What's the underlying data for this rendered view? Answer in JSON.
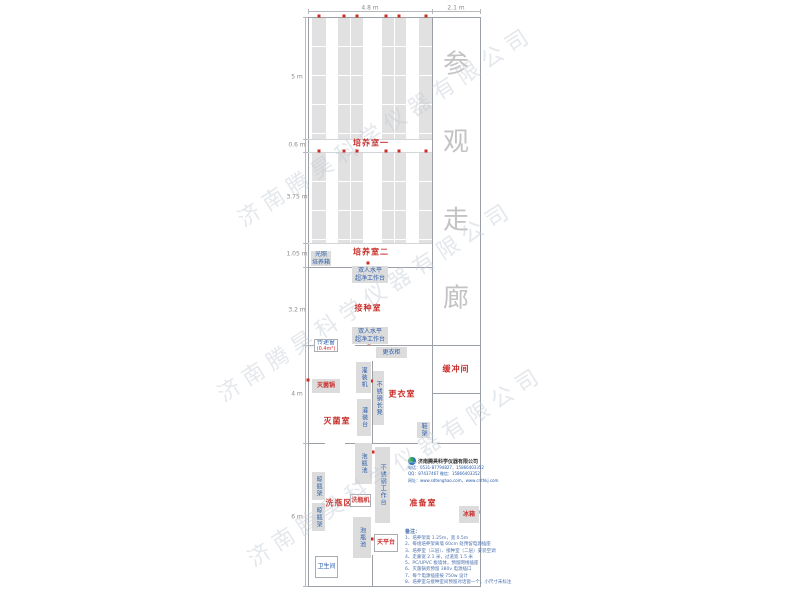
{
  "watermark": {
    "text": "济南腾昊科学仪器有限公司"
  },
  "watermarks": [
    {
      "cx": 385,
      "cy": 125
    },
    {
      "cx": 365,
      "cy": 300
    },
    {
      "cx": 395,
      "cy": 465
    }
  ],
  "corridor": {
    "label": "参观走廊",
    "x": 456,
    "chars": [
      {
        "c": "参",
        "y": 62
      },
      {
        "c": "观",
        "y": 140
      },
      {
        "c": "走",
        "y": 218
      },
      {
        "c": "廊",
        "y": 296
      }
    ]
  },
  "dimensions": {
    "top": {
      "line": {
        "x1": 308,
        "x2": 480,
        "y": 11
      },
      "ticks": [
        308,
        432,
        480
      ],
      "labels": [
        {
          "label": "4.8 m",
          "cx": 370,
          "cy": 8
        },
        {
          "label": "2.1 m",
          "cx": 456,
          "cy": 8
        }
      ]
    },
    "left": {
      "line": {
        "y1": 17,
        "y2": 586,
        "x": 305
      },
      "ticks": [
        17,
        139,
        152,
        243,
        267,
        345,
        443,
        586
      ],
      "labels": [
        {
          "label": "5 m",
          "cy": 77
        },
        {
          "label": "0.6 m",
          "cy": 145
        },
        {
          "label": "3.75 m",
          "cy": 197
        },
        {
          "label": "1.05 m",
          "cy": 254
        },
        {
          "label": "3.2 m",
          "cy": 310
        },
        {
          "label": "4 m",
          "cy": 394
        },
        {
          "label": "6 m",
          "cy": 517
        }
      ]
    }
  },
  "plan": {
    "walls": [
      {
        "x": 308,
        "y": 17,
        "w": 173,
        "h": 1
      },
      {
        "x": 308,
        "y": 586,
        "w": 173,
        "h": 1
      },
      {
        "x": 308,
        "y": 17,
        "w": 1,
        "h": 570
      },
      {
        "x": 480,
        "y": 17,
        "w": 1,
        "h": 570
      },
      {
        "x": 432,
        "y": 17,
        "w": 1,
        "h": 426
      },
      {
        "x": 308,
        "y": 267,
        "w": 125,
        "h": 1
      },
      {
        "x": 308,
        "y": 345,
        "w": 27,
        "h": 1
      },
      {
        "x": 355,
        "y": 345,
        "w": 126,
        "h": 1
      },
      {
        "x": 372,
        "y": 361,
        "w": 1,
        "h": 82
      },
      {
        "x": 432,
        "y": 393,
        "w": 49,
        "h": 1
      },
      {
        "x": 308,
        "y": 443,
        "w": 17,
        "h": 1
      },
      {
        "x": 345,
        "y": 443,
        "w": 73,
        "h": 1
      },
      {
        "x": 437,
        "y": 443,
        "w": 44,
        "h": 1
      },
      {
        "x": 372,
        "y": 555,
        "w": 1,
        "h": 31
      },
      {
        "x": 308,
        "y": 139,
        "w": 124,
        "h": 1,
        "light": true
      },
      {
        "x": 308,
        "y": 152,
        "w": 124,
        "h": 1,
        "light": true
      },
      {
        "x": 308,
        "y": 243,
        "w": 124,
        "h": 1,
        "light": true
      }
    ],
    "rack_sections": [
      {
        "y": 18,
        "h": 121
      },
      {
        "y": 153,
        "h": 90
      }
    ],
    "rack_cols": [
      {
        "x": 312,
        "w": 14
      },
      {
        "x": 338,
        "w": 25,
        "mid": 350
      },
      {
        "x": 382,
        "w": 24,
        "mid": 394
      },
      {
        "x": 419,
        "w": 13
      }
    ],
    "outlet_rows": [
      {
        "y": 16,
        "xs": [
          319,
          344,
          357,
          386,
          399,
          426
        ]
      },
      {
        "y": 151,
        "xs": [
          319,
          344,
          357,
          386,
          399,
          426
        ]
      }
    ],
    "outlets": [
      [
        368,
        263
      ],
      [
        369,
        343
      ],
      [
        372,
        381
      ],
      [
        308,
        380
      ],
      [
        373,
        452
      ],
      [
        369,
        481
      ],
      [
        372,
        539
      ],
      [
        478,
        512
      ]
    ]
  },
  "rooms": [
    {
      "id": "culture-room-1",
      "label": "培养室一",
      "cx": 371,
      "cy": 143
    },
    {
      "id": "culture-room-2",
      "label": "培养室二",
      "cx": 371,
      "cy": 252
    },
    {
      "id": "inoculation-room",
      "label": "接种室",
      "cx": 368,
      "cy": 308
    },
    {
      "id": "sterilization-room",
      "label": "灭菌室",
      "cx": 337,
      "cy": 421
    },
    {
      "id": "changing-room",
      "label": "更衣室",
      "cx": 402,
      "cy": 394
    },
    {
      "id": "buffer-room",
      "label": "缓冲间",
      "cx": 456,
      "cy": 369
    },
    {
      "id": "bottle-washing-area",
      "label": "洗瓶区",
      "cx": 339,
      "cy": 503
    },
    {
      "id": "prep-room",
      "label": "准备室",
      "cx": 423,
      "cy": 503
    }
  ],
  "equipment": [
    {
      "id": "light-incubator",
      "label": "光照\n培养箱",
      "x": 311,
      "y": 251,
      "w": 20,
      "h": 15,
      "style": "gray"
    },
    {
      "id": "clean-bench-1",
      "label": "双人水平\n超净工作台",
      "x": 352,
      "y": 266,
      "w": 36,
      "h": 17,
      "style": "gray"
    },
    {
      "id": "clean-bench-2",
      "label": "双人水平\n超净工作台",
      "x": 352,
      "y": 327,
      "w": 36,
      "h": 17,
      "style": "gray"
    },
    {
      "id": "pass-window",
      "label": "传递窗",
      "sub": "(0.4m²)",
      "x": 314,
      "y": 339,
      "w": 24,
      "h": 13,
      "style": "white"
    },
    {
      "id": "locker",
      "label": "更衣柜",
      "x": 376,
      "y": 347,
      "w": 31,
      "h": 11,
      "style": "gray"
    },
    {
      "id": "filling-machine",
      "label": "灌装机",
      "x": 356,
      "y": 362,
      "w": 15,
      "h": 31,
      "style": "gray",
      "orient": "v"
    },
    {
      "id": "sterilizer",
      "label": "灭菌锅",
      "x": 312,
      "y": 379,
      "w": 28,
      "h": 14,
      "style": "gray",
      "red": true
    },
    {
      "id": "ss-bench",
      "label": "不锈钢长凳",
      "x": 373,
      "y": 371,
      "w": 11,
      "h": 54,
      "style": "gray",
      "orient": "v"
    },
    {
      "id": "filling-table",
      "label": "灌装台",
      "x": 357,
      "y": 399,
      "w": 14,
      "h": 37,
      "style": "gray",
      "orient": "v"
    },
    {
      "id": "shoe-rack",
      "label": "鞋架",
      "x": 417,
      "y": 422,
      "w": 13,
      "h": 16,
      "style": "gray",
      "orient": "v"
    },
    {
      "id": "soak-pool-1",
      "label": "泡瓶池",
      "x": 355,
      "y": 443,
      "w": 17,
      "h": 41,
      "style": "gray",
      "orient": "v"
    },
    {
      "id": "ss-worktable",
      "label": "不锈钢工作台",
      "x": 375,
      "y": 447,
      "w": 15,
      "h": 76,
      "style": "gray",
      "orient": "v"
    },
    {
      "id": "bottle-rack-1",
      "label": "晾瓶架",
      "x": 312,
      "y": 472,
      "w": 13,
      "h": 28,
      "style": "gray",
      "orient": "v"
    },
    {
      "id": "bottle-rack-2",
      "label": "晾瓶架",
      "x": 312,
      "y": 503,
      "w": 13,
      "h": 28,
      "style": "gray",
      "orient": "v"
    },
    {
      "id": "bottle-washer",
      "label": "洗瓶机",
      "x": 350,
      "y": 494,
      "w": 21,
      "h": 13,
      "style": "white",
      "red": true
    },
    {
      "id": "soak-pool-2",
      "label": "泡瓶池",
      "x": 353,
      "y": 517,
      "w": 18,
      "h": 41,
      "style": "gray",
      "orient": "v"
    },
    {
      "id": "balance-table",
      "label": "天平台",
      "x": 374,
      "y": 534,
      "w": 24,
      "h": 18,
      "style": "white",
      "red": true
    },
    {
      "id": "fridge",
      "label": "冰箱",
      "x": 459,
      "y": 506,
      "w": 20,
      "h": 17,
      "style": "gray",
      "red": true
    },
    {
      "id": "toilet",
      "label": "卫生间",
      "x": 315,
      "y": 556,
      "w": 23,
      "h": 22,
      "style": "white"
    }
  ],
  "company": {
    "name": "济南腾昊科学仪器有限公司",
    "lines": [
      "电话：0531-87794827，15866403352",
      "QQ：87437467    微信：15866403352",
      "网址：www.sdtenghao.com，www.cnthkj.com"
    ]
  },
  "notes": {
    "heading": "备注：",
    "items": [
      "1、培养架高 1.25m，宽 0.5m",
      "2、每组培养架离墙 60cm 处预留电源插座",
      "3、培养室（三层）、接种室（二层）安装空调",
      "4、走廊宽 2.1 米，过道宽 1.5 米",
      "5、PC/UPVC 板墙体，预留网线插座",
      "6、灭菌锅旁预留 380v 电源插口",
      "7、每个电源插座按 750w 设计",
      "8、培养室与接种室间预留对话窗一个，小尺寸未标注"
    ]
  }
}
